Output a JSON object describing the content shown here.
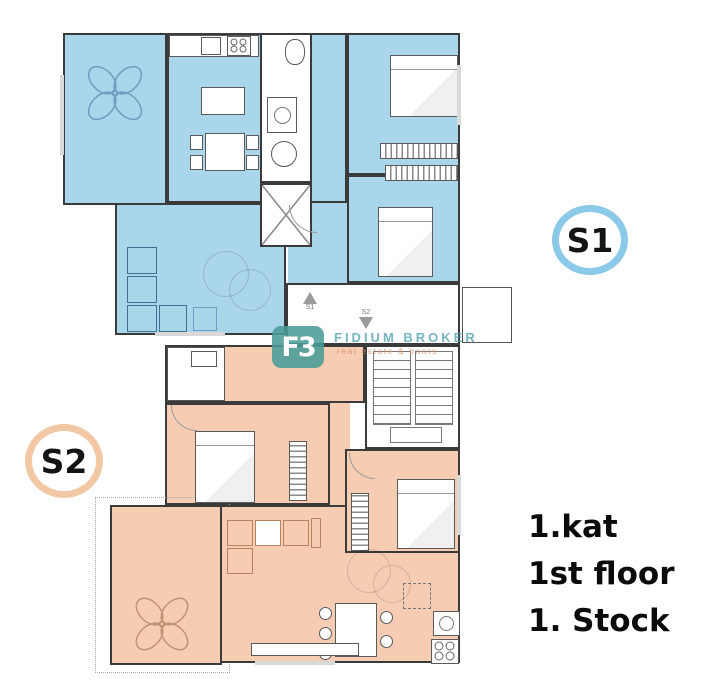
{
  "badges": {
    "s1": "S1",
    "s2": "S2"
  },
  "floor_labels": {
    "line1": "1.kat",
    "line2": "1st floor",
    "line3": "1. Stock"
  },
  "watermark": {
    "logo": "F3",
    "brand": "FIDIUM BROKER",
    "tagline": "real estate & boats"
  },
  "entrances": {
    "s1": "S1",
    "s2": "S2"
  },
  "colors": {
    "apartment_s1_fill": "#aad6eb",
    "apartment_s2_fill": "#f6cdb3",
    "s1_badge_ring": "#8bc9e9",
    "s2_badge_ring": "#f2c7a3",
    "wall": "#3b3b3b",
    "watermark_teal": "#3f9aa6",
    "watermark_orange": "#d8895f",
    "label_text": "#0b0b0b"
  }
}
